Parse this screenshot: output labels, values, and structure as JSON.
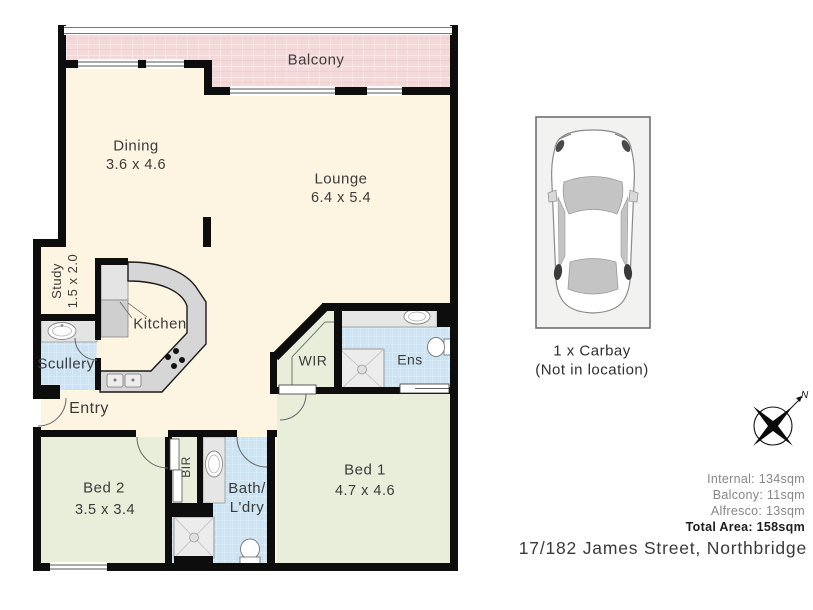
{
  "floorplan": {
    "rooms": {
      "balcony": {
        "label": "Balcony"
      },
      "dining": {
        "label": "Dining",
        "dims": "3.6 x 4.6"
      },
      "lounge": {
        "label": "Lounge",
        "dims": "6.4 x 5.4"
      },
      "study": {
        "label": "Study",
        "dims": "1.5 x 2.0"
      },
      "kitchen": {
        "label": "Kitchen"
      },
      "scullery": {
        "label": "Scullery"
      },
      "entry": {
        "label": "Entry"
      },
      "wir": {
        "label": "WIR"
      },
      "ens": {
        "label": "Ens"
      },
      "bir": {
        "label": "BIR"
      },
      "bath": {
        "label_line1": "Bath/",
        "label_line2": "L'dry"
      },
      "bed1": {
        "label": "Bed 1",
        "dims": "4.7 x 4.6"
      },
      "bed2": {
        "label": "Bed 2",
        "dims": "3.5 x 3.4"
      }
    }
  },
  "carbay": {
    "title": "1 x Carbay",
    "note": "(Not in location)"
  },
  "compass": {
    "north": "N"
  },
  "areas": {
    "internal": "Internal: 134sqm",
    "balcony": "Balcony: 11sqm",
    "alfresco": "Alfresco: 13sqm",
    "total": "Total Area: 158sqm"
  },
  "address": "17/182 James Street, Northbridge",
  "colors": {
    "wall": "#0d0d0d",
    "floor_cream": "#fdf5e1",
    "floor_green": "#e9eedb",
    "floor_tile_blue": "#cde3f1",
    "balcony_pink": "#f3d9d9",
    "counter_gray": "#d6d6d6",
    "text": "#3b3b3b"
  }
}
